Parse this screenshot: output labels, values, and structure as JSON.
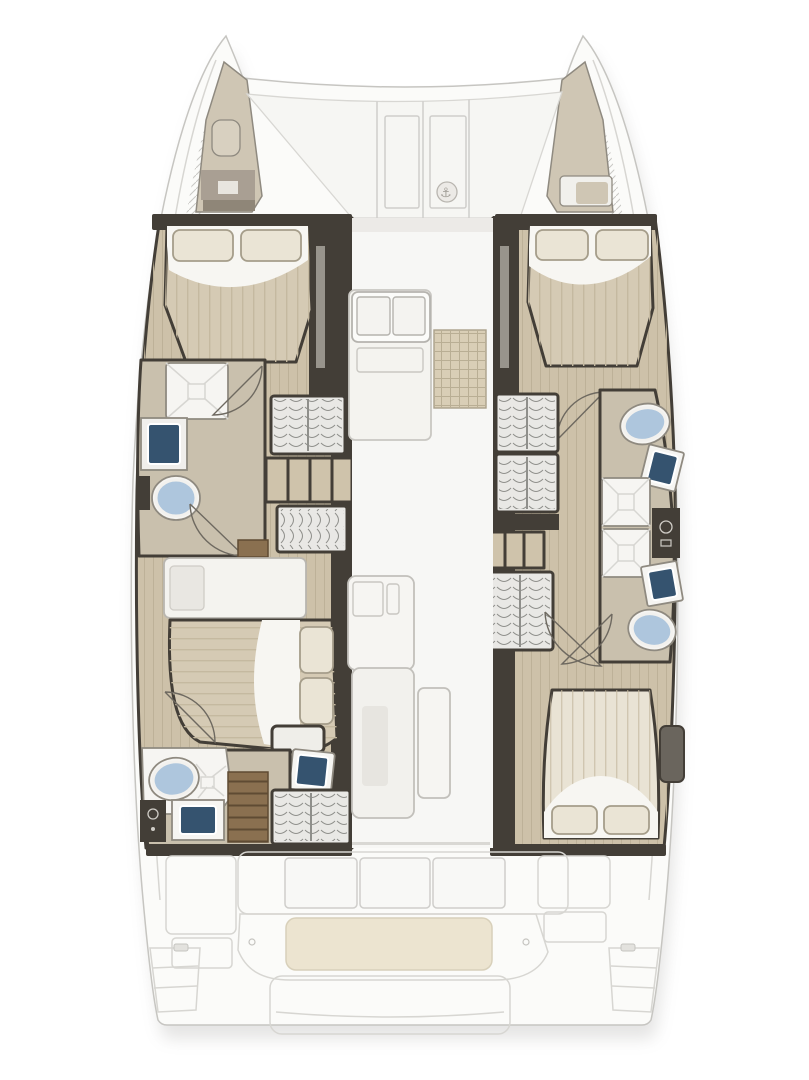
{
  "image": {
    "kind": "catamaran-floorplan",
    "view": "top-down interior deck plan",
    "visible_text": ""
  },
  "icons": {
    "windlass": "⚓"
  },
  "colors": {
    "page": "#ffffff",
    "deck": "#fbfbf9",
    "deckline": "#c6c5c1",
    "softline": "#d7d6d2",
    "panelline": "#cfcecb",
    "wall": "#433e37",
    "wood": "#cdc1a9",
    "woodline": "#bdb198",
    "bath": "#c9c0ad",
    "blanket": "#d5cab4",
    "blanketline": "#c5b9a0",
    "sheet": "#f7f6f2",
    "pillow": "#eae4d5",
    "pillowline": "#a59d8a",
    "toilet": "#aec6dd",
    "sink": "#35536f",
    "fixture": "#f6f5f2",
    "fixline": "#8f8a80",
    "hangerbg": "#e9e8e5",
    "hangerline": "#8f8f8b",
    "shelf": "#cfc3ab",
    "drawer": "#8a7050",
    "drawerline": "#5f4b33",
    "gridmat": "#d9ceb6",
    "gridline": "#b9ae94",
    "cushion": "#ece4d0",
    "cushionline": "#d8d0ba",
    "forepeak": "#cfc6b4",
    "hatchline": "#c9c8c4",
    "arcline": "#6e6960",
    "iconink": "#a5a29b",
    "shadow": "#8a8884",
    "wallstripe": "#98948c"
  },
  "diagram_data": {
    "type": "diagram",
    "subject": "catamaran sailing yacht accommodation floor plan, bow at top, stern at bottom",
    "hulls": [
      "port",
      "starboard"
    ],
    "rooms": [
      {
        "name": "port forepeak locker",
        "hull": "port",
        "position": "bow"
      },
      {
        "name": "starboard forepeak locker",
        "hull": "starboard",
        "position": "bow"
      },
      {
        "name": "foredeck with locker hatches and windlass",
        "hull": "bridgedeck",
        "position": "bow"
      },
      {
        "name": "port forward double cabin",
        "hull": "port",
        "fixtures": [
          "double bed",
          "2 pillows"
        ]
      },
      {
        "name": "port forward bathroom",
        "hull": "port",
        "fixtures": [
          "shower",
          "sink",
          "toilet"
        ]
      },
      {
        "name": "port wardrobe area",
        "hull": "port",
        "fixtures": [
          "hanging locker",
          "shelves",
          "hanging locker"
        ]
      },
      {
        "name": "port aft double cabin",
        "hull": "port",
        "fixtures": [
          "double bed",
          "2 pillows",
          "nightstand",
          "vanity sink",
          "desk"
        ]
      },
      {
        "name": "port aft bathroom",
        "hull": "port",
        "fixtures": [
          "toilet",
          "shower",
          "sink",
          "drawer steps",
          "hanging locker"
        ]
      },
      {
        "name": "starboard forward double cabin",
        "hull": "starboard",
        "fixtures": [
          "double bed",
          "2 pillows"
        ]
      },
      {
        "name": "starboard wardrobe area",
        "hull": "starboard",
        "fixtures": [
          "hanging locker",
          "hanging locker",
          "shelves",
          "hanging locker"
        ]
      },
      {
        "name": "starboard bathrooms",
        "hull": "starboard",
        "fixtures": [
          "toilet",
          "sink",
          "shower",
          "shower",
          "cabinet",
          "sink",
          "toilet"
        ]
      },
      {
        "name": "starboard aft double cabin",
        "hull": "starboard",
        "fixtures": [
          "double bed",
          "2 pillows",
          "nightstand"
        ]
      },
      {
        "name": "salon",
        "hull": "bridgedeck",
        "fixtures": [
          "galley counter with double sink",
          "stove mat",
          "chart table",
          "sofa unit",
          "door panel"
        ]
      },
      {
        "name": "cockpit",
        "hull": "bridgedeck",
        "position": "stern",
        "fixtures": [
          "seatback panels",
          "bench with cushion",
          "side benches",
          "stern platform",
          "swim steps"
        ]
      }
    ],
    "fixture_counts": {
      "double_beds": 4,
      "toilets": 4,
      "sinks": 6,
      "showers": 4,
      "hanging_lockers": 6,
      "cabins": 4
    }
  }
}
